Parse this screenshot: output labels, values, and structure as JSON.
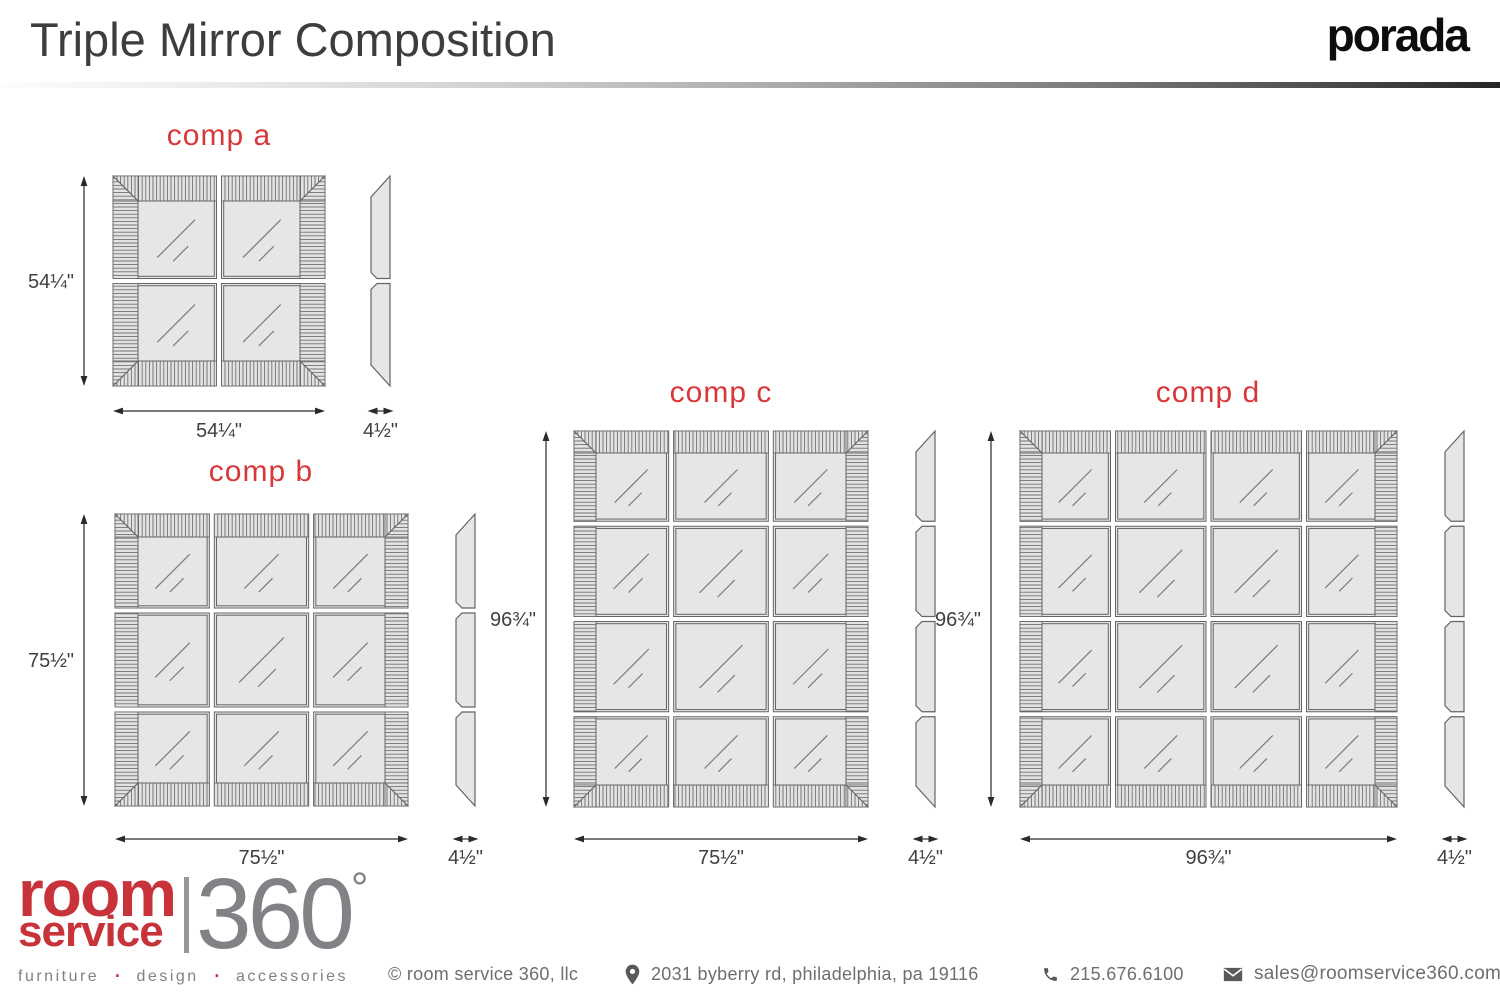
{
  "header": {
    "title": "Triple Mirror Composition",
    "brand": "porada"
  },
  "compositions": [
    {
      "id": "a",
      "label": "comp a",
      "grid": {
        "rows": 2,
        "cols": 2
      },
      "side_pieces": 2,
      "height_label": "54¼\"",
      "width_label": "54¼\"",
      "side_label": "4½\""
    },
    {
      "id": "b",
      "label": "comp b",
      "grid": {
        "rows": 3,
        "cols": 3
      },
      "side_pieces": 3,
      "height_label": "75½\"",
      "width_label": "75½\"",
      "side_label": "4½\""
    },
    {
      "id": "c",
      "label": "comp c",
      "grid": {
        "rows": 4,
        "cols": 3
      },
      "side_pieces": 4,
      "height_label": "96¾\"",
      "width_label": "75½\"",
      "side_label": "4½\""
    },
    {
      "id": "d",
      "label": "comp d",
      "grid": {
        "rows": 4,
        "cols": 4
      },
      "side_pieces": 4,
      "height_label": "96¾\"",
      "width_label": "96¾\"",
      "side_label": "4½\""
    }
  ],
  "footer": {
    "logo": {
      "line1": "room",
      "line2": "service",
      "number": "360",
      "degree": "°",
      "separator": "·",
      "tagline_words": [
        "furniture",
        "design",
        "accessories"
      ]
    },
    "copyright": "© room service 360, llc",
    "address": "2031 byberry rd, philadelphia, pa 19116",
    "phone": "215.676.6100",
    "email": "sales@roomservice360.com",
    "icons": {
      "location": "map-pin-icon",
      "phone": "phone-handset-icon",
      "email": "envelope-icon"
    }
  },
  "colors": {
    "accent_red": "#d8383a",
    "logo_red": "#c8333a",
    "title_gray": "#3d3d3e",
    "footer_gray": "#6d6e71",
    "logo_gray": "#808285",
    "icon_gray": "#58595b",
    "dim_text": "#3f4040",
    "arrow_line": "#2a2a2a",
    "panel_border": "#636466",
    "hatch_line": "#6f7072",
    "mirror_fill": "#e6e6e7",
    "strip_fill": "#e3e3e4"
  }
}
